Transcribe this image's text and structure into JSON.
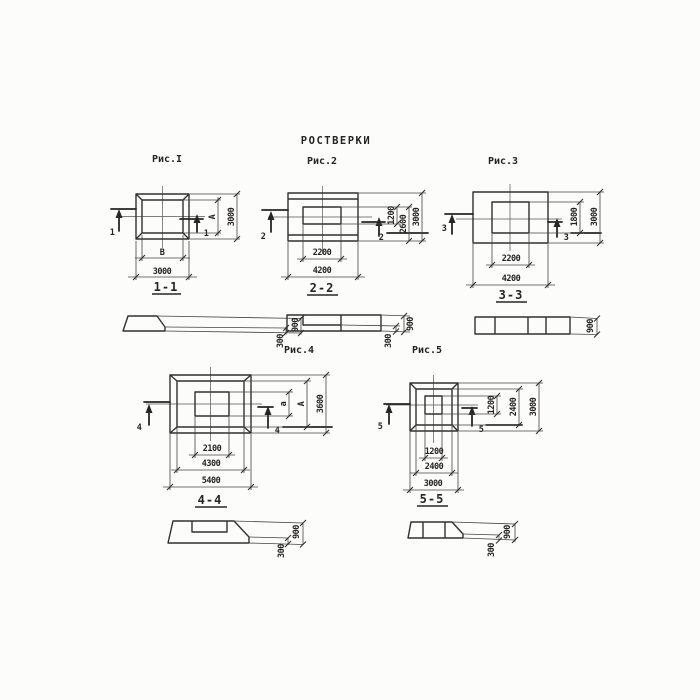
{
  "title": "РОСТВЕРКИ",
  "colors": {
    "line": "#30302e",
    "background": "#fcfcfa"
  },
  "figures": [
    {
      "caption": "Рис.I",
      "section_label": "1-1",
      "cut_mark": "1",
      "plan_dims": {
        "inner_width": "В",
        "outer_width": "3000",
        "inner_height": "А",
        "outer_height": "3000"
      },
      "section_dims": {
        "total_height": "900",
        "step_height": "300"
      }
    },
    {
      "caption": "Рис.2",
      "section_label": "2-2",
      "cut_mark": "2",
      "plan_dims": {
        "inner_width": "2200",
        "outer_width": "4200",
        "inner_height": "1200",
        "mid_height": "2600",
        "outer_height": "3000"
      },
      "section_dims": {
        "total_height": "900",
        "step_height": "300"
      }
    },
    {
      "caption": "Рис.3",
      "section_label": "3-3",
      "cut_mark": "3",
      "plan_dims": {
        "inner_width": "2200",
        "outer_width": "4200",
        "inner_height": "1800",
        "outer_height": "3000"
      },
      "section_dims": {
        "total_height": "900"
      }
    },
    {
      "caption": "Рис.4",
      "section_label": "4-4",
      "cut_mark": "4",
      "plan_dims": {
        "inner_width": "2100",
        "mid_width": "4300",
        "outer_width": "5400",
        "inner_height": "а",
        "mid_height": "А",
        "outer_height": "3600"
      },
      "section_dims": {
        "total_height": "900",
        "step_height": "300"
      }
    },
    {
      "caption": "Рис.5",
      "section_label": "5-5",
      "cut_mark": "5",
      "plan_dims": {
        "inner_width": "1200",
        "mid_width": "2400",
        "outer_width": "3000",
        "inner_height": "1200",
        "mid_height": "2400",
        "outer_height": "3000"
      },
      "section_dims": {
        "total_height": "900",
        "step_height": "300"
      }
    }
  ]
}
